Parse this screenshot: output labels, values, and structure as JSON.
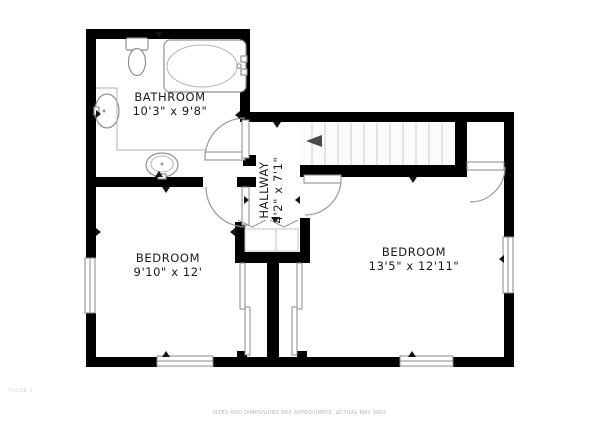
{
  "rooms": {
    "bathroom": {
      "name": "BATHROOM",
      "dims": "10'3\" x 9'8\""
    },
    "hallway": {
      "name": "HALLWAY",
      "dims": "4'2\" x 7'1\""
    },
    "bedroom_left": {
      "name": "BEDROOM",
      "dims": "9'10\" x 12'"
    },
    "bedroom_right": {
      "name": "BEDROOM",
      "dims": "13'5\" x 12'11\""
    }
  },
  "footer": {
    "disclaimer": "SIZES AND DIMENSIONS ARE APPROXIMATE, ACTUAL MAY VARY."
  },
  "corner_note": "FLOOR 2",
  "colors": {
    "wall": "#000000",
    "background": "#ffffff",
    "fixture_outline": "#8f8f8f",
    "stair_tread": "#cccccc",
    "label_text": "#1a1a1a",
    "footer_text": "#b5b5b5"
  }
}
